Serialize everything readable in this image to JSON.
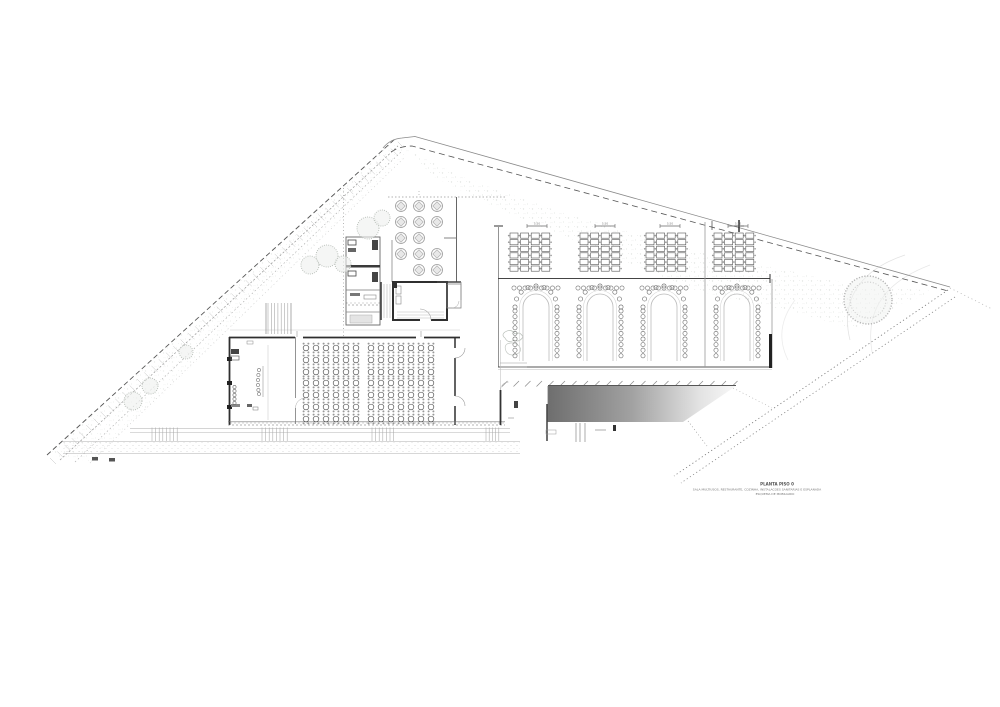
{
  "title_block": {
    "line1": "PLANTA PISO 0",
    "line2": "SALA MULTIUSOS, RESTAURANTE, COZINHA, INSTALACOES SANITARIAS E ESPLANADA",
    "line3": "ESQUEMA DE MOBILIARIO"
  },
  "dimension_labels": [
    "5.50",
    "5.50",
    "5.50",
    "5.50"
  ],
  "colors": {
    "paper": "#ffffff",
    "wall_dark": "#2f2f2f",
    "line_mid": "#8a8a8a",
    "line_light": "#c9c9c9",
    "ramp_dark": "#6e6e6e",
    "vegetation": "#b9c0b9"
  },
  "floorplan": {
    "dining_terrace": {
      "cols": [
        401,
        419,
        437
      ],
      "rows": [
        206,
        222,
        238,
        254,
        270
      ],
      "skip": [
        [
          2,
          2
        ],
        [
          0,
          4
        ]
      ],
      "table_r": 5.5
    },
    "banquet_groups": {
      "x_starts": [
        510,
        580,
        646,
        714
      ],
      "cols_per_group": 4,
      "col_step": 10.6,
      "rows": 6,
      "row_h": 6.6,
      "top_y": 233,
      "cell_w": 8,
      "cell_h": 5.2
    },
    "u_tables": {
      "centers": [
        536,
        600,
        664,
        737
      ],
      "arc_cy": 307,
      "outer_r": 21,
      "leg_bottom": 361,
      "chair_r": 2.1,
      "chair_step": 5.6,
      "top_row_y": 288
    },
    "ballroom_tables": {
      "cols_a": [
        306,
        316,
        326,
        336,
        346,
        356
      ],
      "cols_b": [
        371,
        381,
        391,
        401,
        411,
        421,
        431
      ],
      "rows": [
        348,
        360,
        372,
        383,
        395,
        407,
        419
      ],
      "table_r": 2.8
    },
    "dimension_bars": {
      "centers": [
        537,
        605,
        670,
        738
      ],
      "y": 226,
      "half_w": 10
    },
    "step_hatches": [
      {
        "x0": 152,
        "n": 8,
        "step": 3.6
      },
      {
        "x0": 262,
        "n": 8,
        "step": 3.6
      },
      {
        "x0": 372,
        "n": 7,
        "step": 3.6
      },
      {
        "x0": 486,
        "n": 5,
        "step": 3.2
      }
    ],
    "stair_hatch": {
      "x0": 268,
      "n": 7,
      "step": 3.3,
      "y1": 303,
      "y2": 334
    },
    "ramp_ticks": {
      "x0": 502,
      "x1": 733,
      "step": 11.5,
      "y": 383
    },
    "trees_left": [
      [
        133,
        401,
        9
      ],
      [
        150,
        386,
        8
      ],
      [
        186,
        352,
        7
      ],
      [
        310,
        265,
        9
      ],
      [
        327,
        256,
        11
      ],
      [
        343,
        264,
        8
      ],
      [
        368,
        228,
        11
      ],
      [
        382,
        218,
        8
      ]
    ],
    "tree_right": [
      868,
      300,
      24
    ],
    "boundary": {
      "left_slope": [
        47,
        455,
        395,
        139
      ],
      "slope_tick_count": 48,
      "top_solid": "M383 148 Q390 139 402 138 L415 136.5 L950 287",
      "top_dashed": "M391 152 Q400 146 412 146 L950 291.5",
      "corner_ext": [
        950,
        288,
        992,
        309
      ],
      "road": [
        [
          948,
          290,
          674,
          476
        ],
        [
          955,
          297,
          681,
          483
        ]
      ],
      "road_connector": [
        688,
        421,
        707,
        446
      ]
    }
  }
}
